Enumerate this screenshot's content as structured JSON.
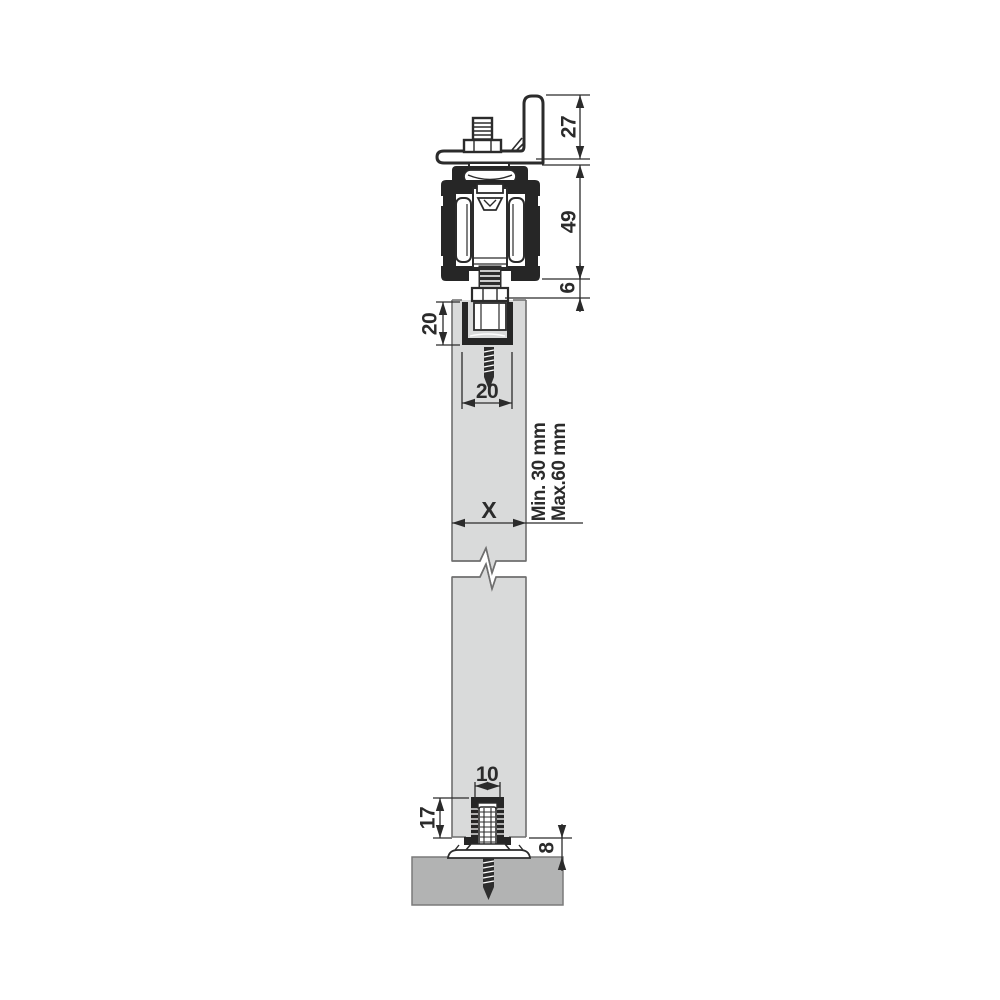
{
  "drawing": {
    "title": "sliding-door-hardware-cross-section",
    "dimensions": {
      "bracket_height": {
        "label": "27"
      },
      "track_height": {
        "label": "49"
      },
      "clearance_under_track": {
        "label": "6"
      },
      "top_channel_depth": {
        "label": "20"
      },
      "top_channel_width": {
        "label": "20"
      },
      "door_thickness": {
        "label": "X"
      },
      "door_thickness_min": {
        "label": "Min. 30 mm"
      },
      "door_thickness_max": {
        "label": "Max.60 mm"
      },
      "bottom_groove_width": {
        "label": "10"
      },
      "bottom_guide_depth": {
        "label": "17"
      },
      "floor_clearance": {
        "label": "8"
      }
    },
    "colors": {
      "line": "#2b2b2b",
      "hardware_black": "#262626",
      "door_fill": "#d9dada",
      "door_stroke": "#6f6f6f",
      "floor_fill": "#b2b3b3",
      "background": "#ffffff"
    }
  }
}
